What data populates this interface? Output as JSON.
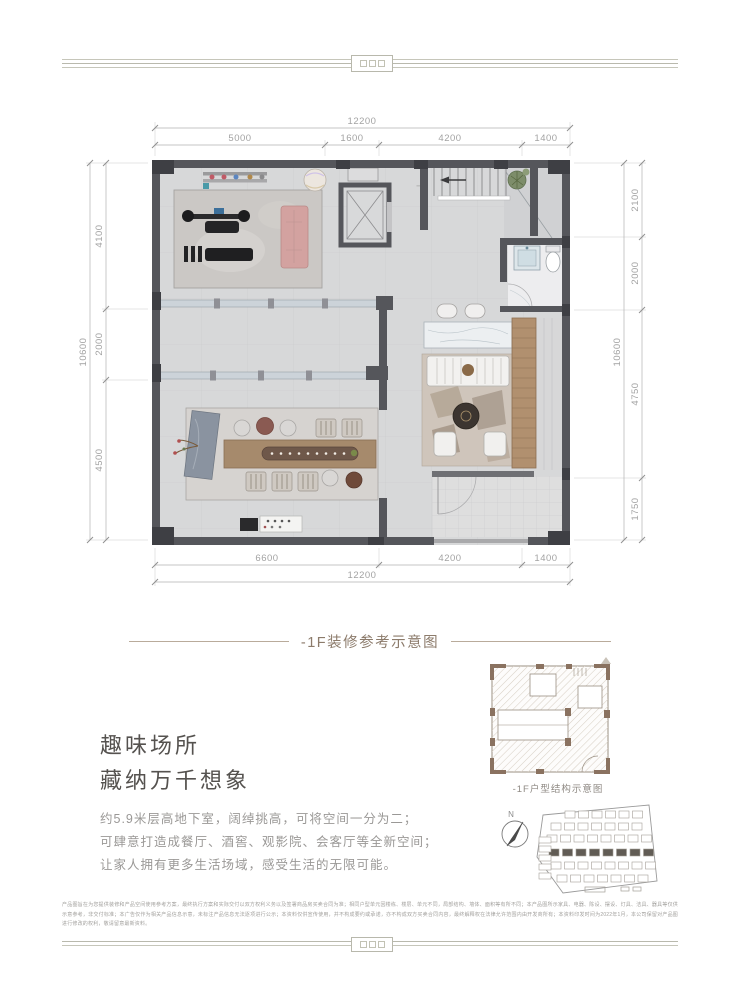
{
  "captions": {
    "main": "-1F装修参考示意图",
    "structure": "-1F户型结构示意图"
  },
  "floor_plan": {
    "stairs_label": "上",
    "dims": {
      "top_total": "12200",
      "top_segments": [
        "5000",
        "1600",
        "4200",
        "1400"
      ],
      "bottom_segments": [
        "6600",
        "4200",
        "1400"
      ],
      "bottom_total": "12200",
      "left_total": "10600",
      "left_segments": [
        "4100",
        "2000",
        "4500"
      ],
      "right_segments": [
        "2100",
        "2000",
        "4750",
        "1750"
      ],
      "right_total": "10600"
    }
  },
  "marketing": {
    "heading_line1": "趣味场所",
    "heading_line2": "藏纳万千想象",
    "body_lines": [
      "约5.9米层高地下室，阔绰挑高，可将空间一分为二；",
      "可肆意打造成餐厅、酒窖、观影院、会客厅等全新空间；",
      "让家人拥有更多生活场域，感受生活的无限可能。"
    ]
  },
  "site_plan": {
    "north_label": "N"
  },
  "disclaimer": "产品图旨在为您提供装修和产品空间使用参考方案，最终执行方案和实际交付以双方权利义务以及签署商品房买卖合同为准；相同户型单元因楼栋、楼层、单元不同，局部结构、墙体、面积等有所不同；本产品图所示家具、电器、陈设、摆设、灯具、洁具、器具等仅供示意参考，非交付标准；本广告仅作为相关产品信息示意，未标注产品信息无法逐项进行公示；本资料仅供宣传使用，并不构成要约或承诺，亦不构成双方买卖合同内容，最终解释权在法律允许范围内由开发商所有；本资料印发时间为2022年1月，本公司保留对产品图进行修改的权利，敬请留意最新资料。",
  "colors": {
    "accent_taupe": "#8c7b6b",
    "wall_dark": "#55565b",
    "wood": "#b1906f",
    "glass": "#ccd3d9",
    "mat_pink": "#d3a2a0"
  }
}
